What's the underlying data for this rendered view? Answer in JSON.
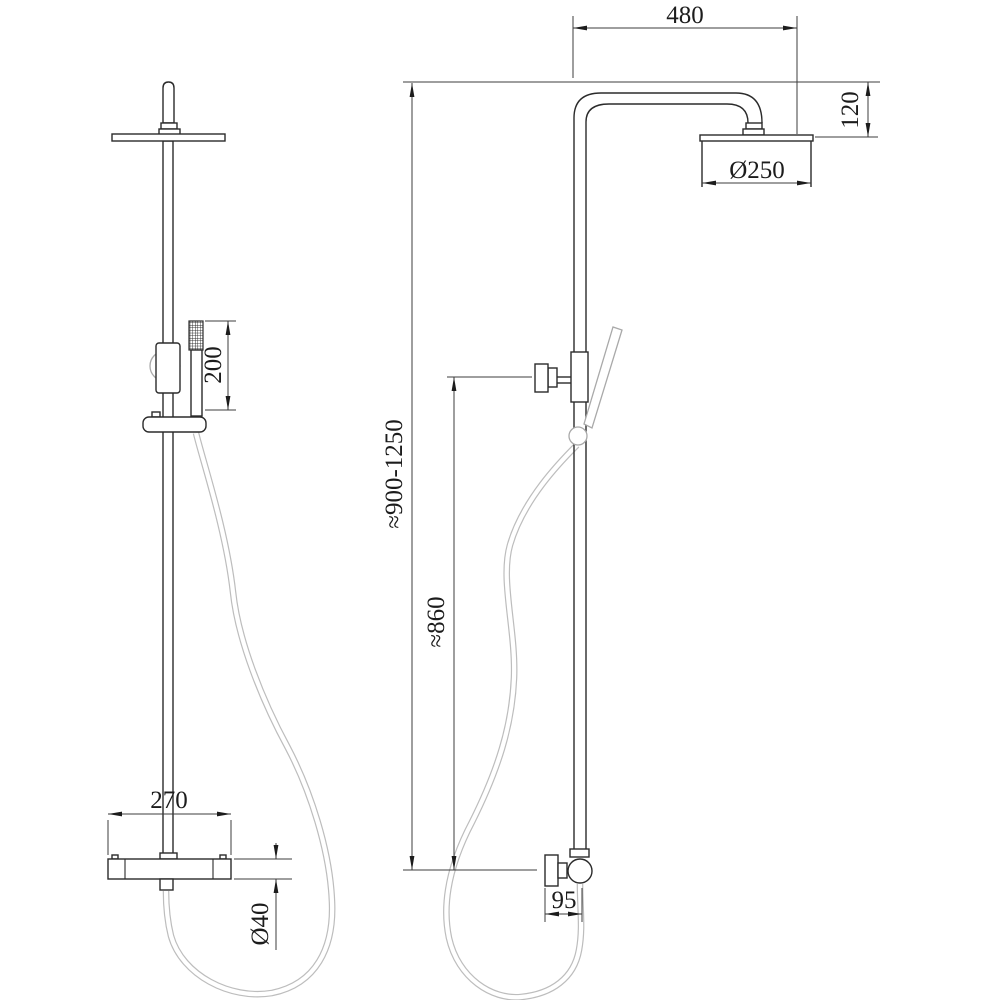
{
  "drawing": {
    "type": "technical-dimension-drawing",
    "subject": "thermostatic shower column with overhead rain shower and hand shower",
    "views": {
      "left": "front view",
      "right": "side view"
    },
    "line_color": "#2b2b2b",
    "hose_color": "#bdbdbd",
    "dimensions": {
      "arm_reach": "480",
      "head_drop": "120",
      "head_diameter": "Ø250",
      "column_height_range": "≈900-1250",
      "slider_height": "≈860",
      "handshower_length": "200",
      "mixer_width": "270",
      "mixer_bar_diameter": "Ø40",
      "wall_offset": "95"
    }
  }
}
